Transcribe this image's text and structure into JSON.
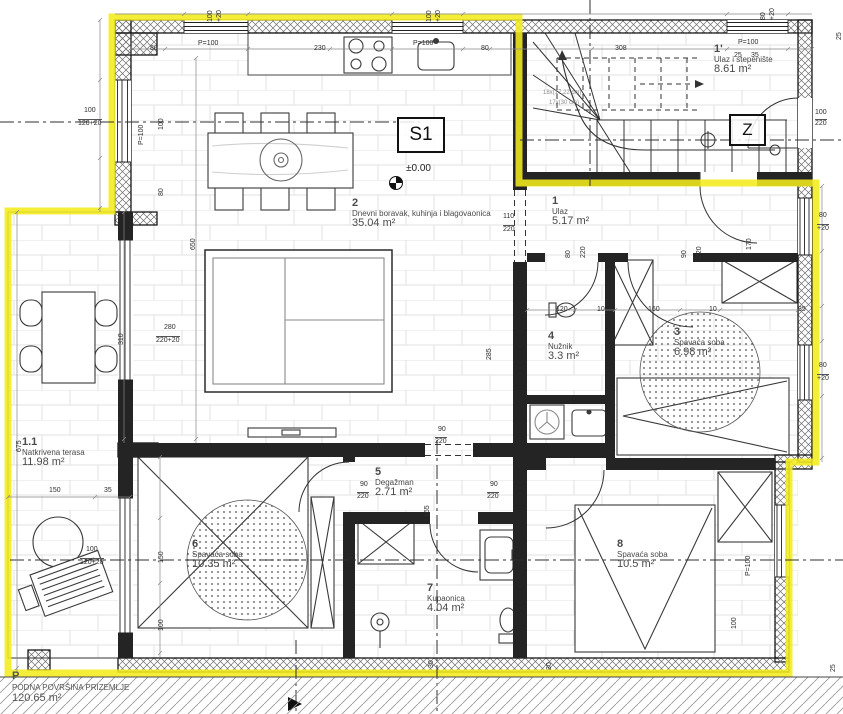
{
  "title": "Ground floor plan S1",
  "colors": {
    "boundary": "#f4ec1c",
    "wall": "#1f1f1f",
    "dim_text": "#2e2e2e",
    "label_text": "#4a4a4a"
  },
  "markers": {
    "unit": "S1",
    "stair_zone": "Z",
    "level": "±0.00",
    "stair_note_1": "18x(17,22 cm)",
    "stair_note_2": "17x(30 cm)"
  },
  "rooms": [
    {
      "num": "1'",
      "name": "Ulaz i stepenište",
      "area": "8.61 m²"
    },
    {
      "num": "1",
      "name": "Ulaz",
      "area": "5.17 m²"
    },
    {
      "num": "2",
      "name": "Dnevni boravak, kuhinja i blagovaonica",
      "area": "35.04 m²"
    },
    {
      "num": "3",
      "name": "Spavaća soba",
      "area": "6.98 m²"
    },
    {
      "num": "4",
      "name": "Nužnik",
      "area": "3.3 m²"
    },
    {
      "num": "5",
      "name": "Degažman",
      "area": "2.71 m²"
    },
    {
      "num": "6",
      "name": "Spavaća soba",
      "area": "10.35 m²"
    },
    {
      "num": "7",
      "name": "Kupaonica",
      "area": "4.04 m²"
    },
    {
      "num": "8",
      "name": "Spavaća soba",
      "area": "10.5 m²"
    },
    {
      "num": "1.1",
      "name": "Natkrivena terasa",
      "area": "11.98 m²"
    }
  ],
  "floor_summary": {
    "num": "P",
    "name": "PODNA POVRŠINA PRIZEMLJE",
    "area": "120.65 m²"
  },
  "dims": [
    {
      "t": "P=100"
    },
    {
      "t": "80"
    },
    {
      "t": "230"
    },
    {
      "t": "P=100"
    },
    {
      "t": "80"
    },
    {
      "t": "308"
    },
    {
      "t": "P=100"
    },
    {
      "t": "25"
    },
    {
      "t": "35"
    },
    {
      "t": "100"
    },
    {
      "t": "220"
    },
    {
      "t": "170"
    },
    {
      "t": "80"
    },
    {
      "t": "+20"
    },
    {
      "t": "80"
    },
    {
      "t": "+20"
    },
    {
      "t": "35"
    },
    {
      "t": "110"
    },
    {
      "t": "220"
    },
    {
      "t": "90"
    },
    {
      "t": "220"
    },
    {
      "t": "90"
    },
    {
      "t": "220"
    },
    {
      "t": "90"
    },
    {
      "t": "220"
    },
    {
      "t": "80"
    },
    {
      "t": "220"
    },
    {
      "t": "90"
    },
    {
      "t": "220"
    },
    {
      "t": "120"
    },
    {
      "t": "160"
    },
    {
      "t": "10"
    },
    {
      "t": "10"
    },
    {
      "t": "100"
    },
    {
      "t": "120+20"
    },
    {
      "t": "P=100"
    },
    {
      "t": "100"
    },
    {
      "t": "80"
    },
    {
      "t": "280"
    },
    {
      "t": "220+20"
    },
    {
      "t": "650"
    },
    {
      "t": "310"
    },
    {
      "t": "675"
    },
    {
      "t": "150"
    },
    {
      "t": "35"
    },
    {
      "t": "150"
    },
    {
      "t": "100"
    },
    {
      "t": "100"
    },
    {
      "t": "120+20"
    },
    {
      "t": "285"
    },
    {
      "t": "165"
    },
    {
      "t": "30"
    },
    {
      "t": "30"
    },
    {
      "t": "25"
    },
    {
      "t": "25"
    },
    {
      "t": "100"
    },
    {
      "t": "+20"
    },
    {
      "t": "100"
    },
    {
      "t": "+20"
    },
    {
      "t": "80"
    },
    {
      "t": "+20"
    },
    {
      "t": "P=100"
    },
    {
      "t": "100"
    }
  ]
}
